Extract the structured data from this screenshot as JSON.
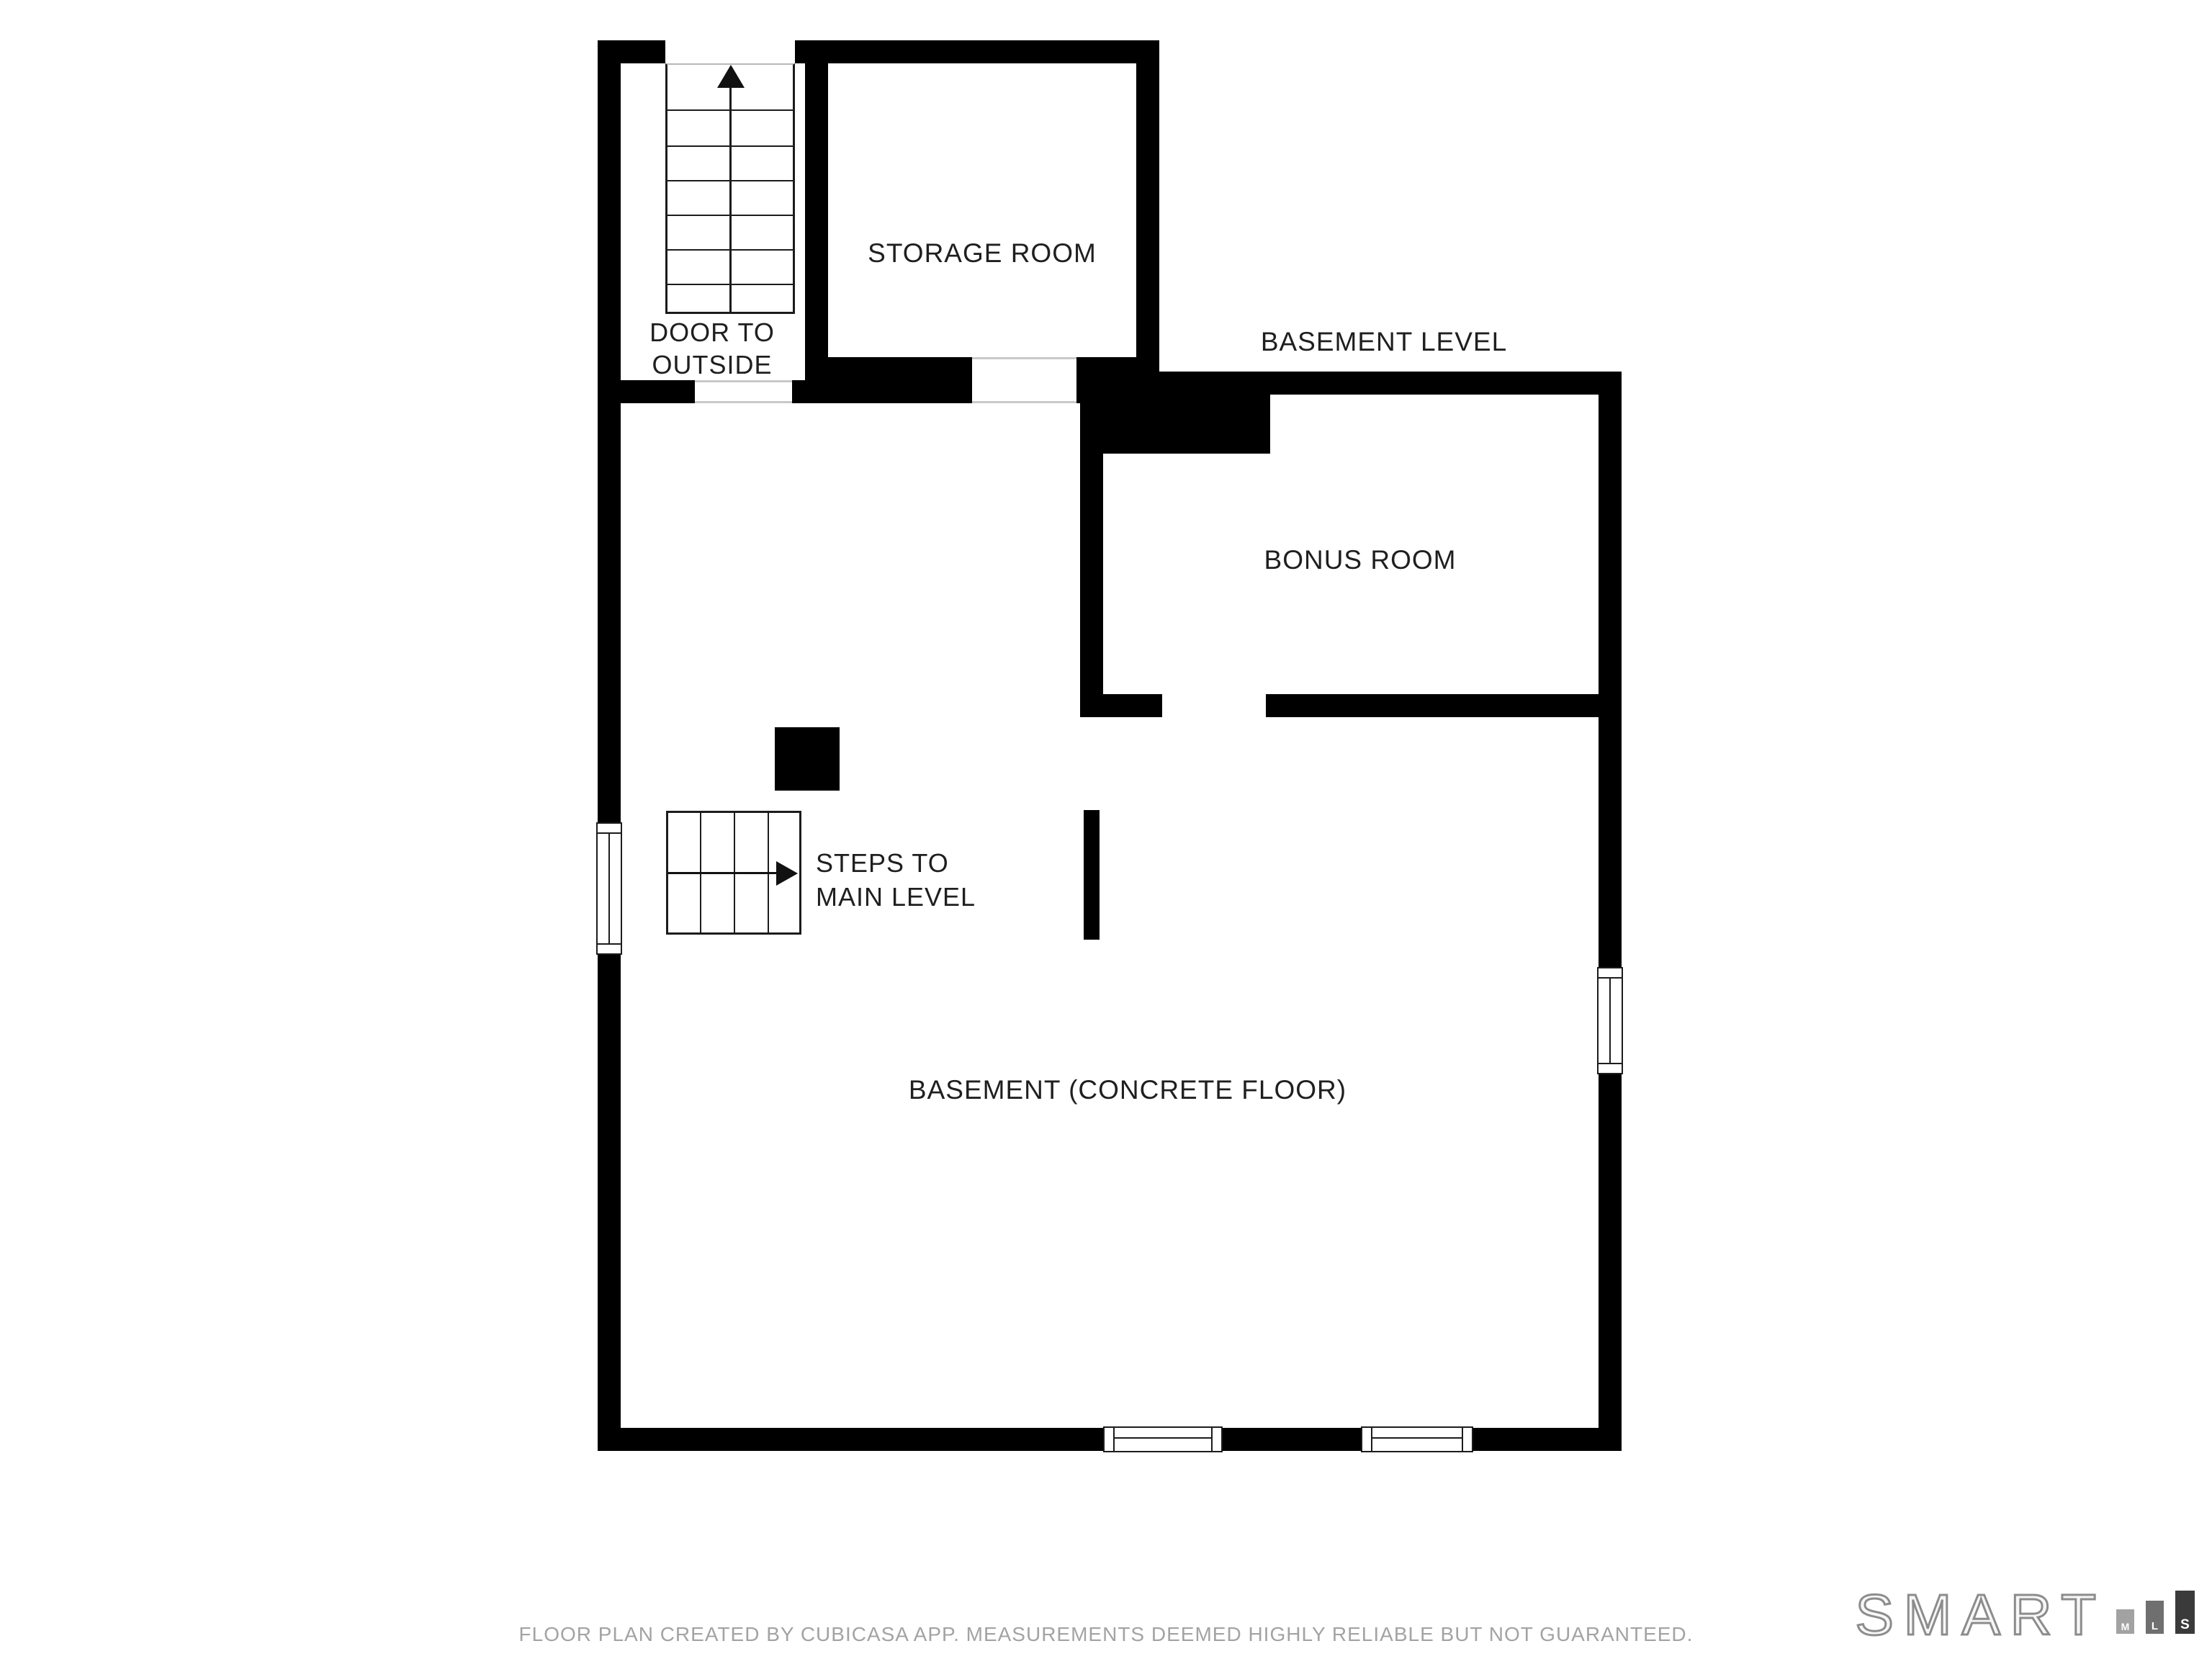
{
  "title": {
    "text": "BASEMENT LEVEL"
  },
  "rooms": {
    "storage_room": {
      "label": "STORAGE ROOM"
    },
    "bonus_room": {
      "label": "BONUS ROOM"
    },
    "basement": {
      "label": "BASEMENT (CONCRETE FLOOR)"
    }
  },
  "annotations": {
    "door_to_outside": {
      "line1": "DOOR TO",
      "line2": "OUTSIDE"
    },
    "steps_to_main_level": {
      "line1": "STEPS TO",
      "line2": "MAIN LEVEL"
    }
  },
  "footer": {
    "disclaimer": "FLOOR PLAN CREATED BY CUBICASA APP. MEASUREMENTS DEEMED HIGHLY RELIABLE BUT NOT GUARANTEED."
  },
  "branding": {
    "logo_text": "SMART",
    "bars": [
      {
        "letter": "M",
        "color": "#a2a2a2"
      },
      {
        "letter": "L",
        "color": "#6f6f6f"
      },
      {
        "letter": "S",
        "color": "#3a3a3a"
      }
    ],
    "outline_color": "#8c8c8c"
  },
  "colors": {
    "wall": "#000000",
    "stair_line": "#1c1c1c",
    "label_text": "#1f1f1f",
    "footer_text": "#a3a3a3",
    "threshold": "#c9c9c9",
    "background": "#ffffff"
  }
}
